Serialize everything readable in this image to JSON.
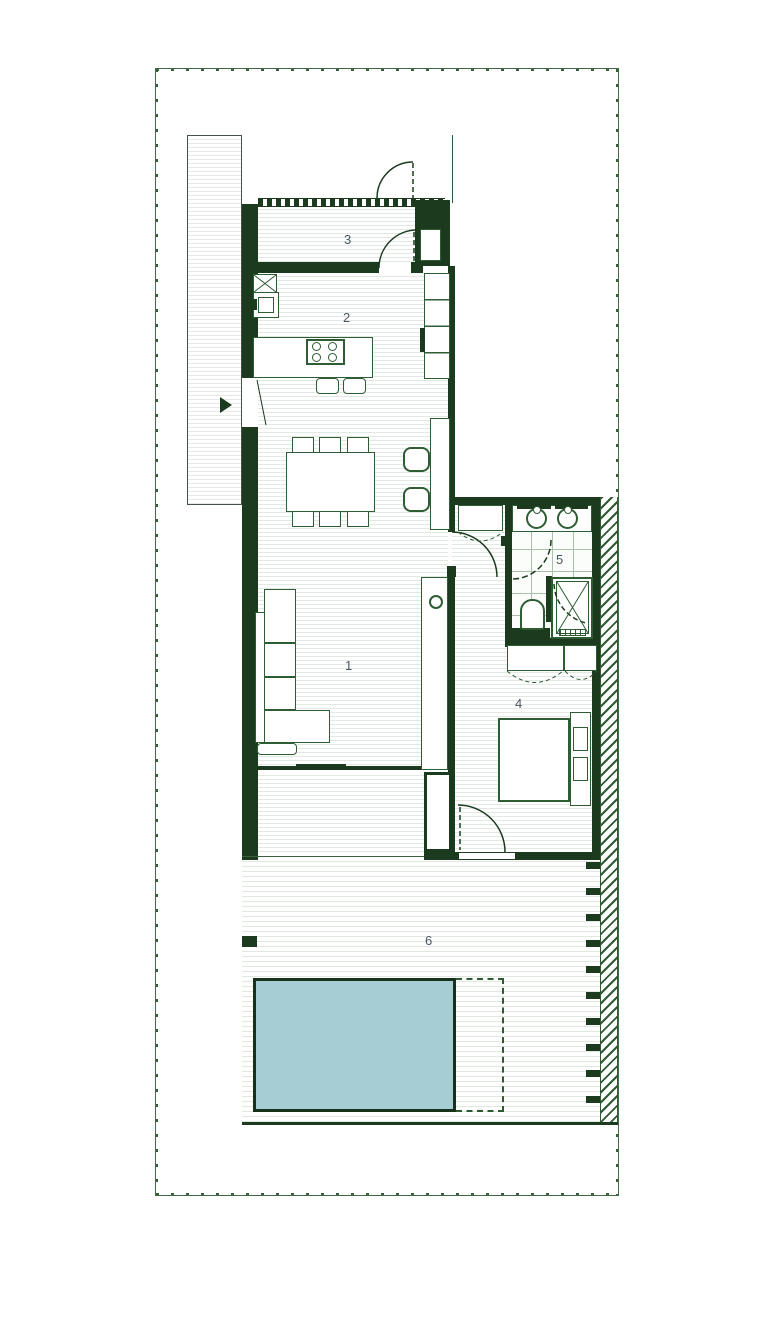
{
  "rooms": {
    "living": {
      "label": "1"
    },
    "kitchen": {
      "label": "2"
    },
    "entry": {
      "label": "3"
    },
    "bedroom": {
      "label": "4"
    },
    "bathroom": {
      "label": "5"
    },
    "terrace": {
      "label": "6"
    }
  },
  "colors": {
    "wall": "#1b3a1e",
    "outline": "#2e5c33",
    "floor_stripe": "#e2e9e2",
    "tile_line": "#a9bfaa",
    "hatch": "#2d5a30",
    "pool_fill": "#a6cdd4",
    "pool_border": "#16321a",
    "room_label": "#4a5761",
    "background": "#ffffff"
  }
}
